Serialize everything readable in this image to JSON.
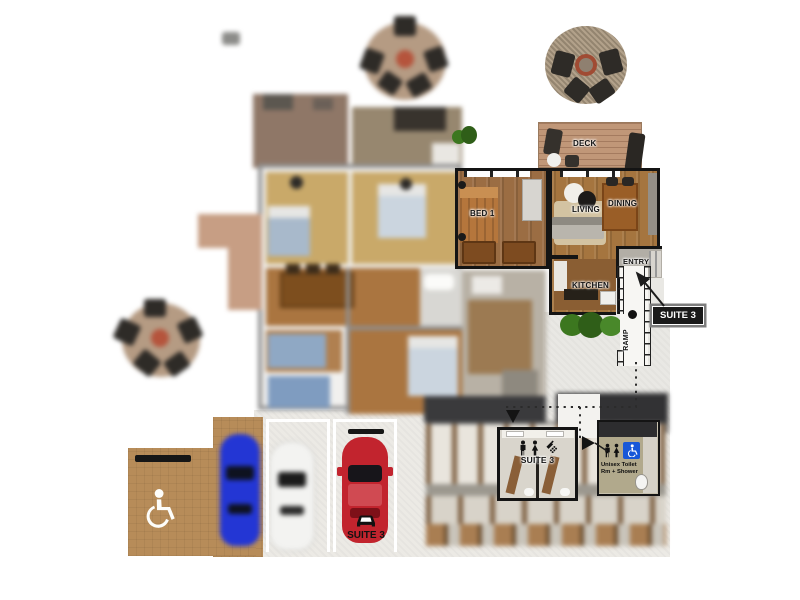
{
  "unit": {
    "bed1": "BED 1",
    "living": "LIVING",
    "dining": "DINING",
    "kitchen": "KITCHEN",
    "entry": "ENTRY",
    "deck": "DECK"
  },
  "site": {
    "ramp": "RAMP",
    "suite_callout": "SUITE 3"
  },
  "bathhouse": {
    "suite_restroom": "SUITE 3",
    "unisex": "Unisex Toilet Rm + Shower"
  },
  "parking": {
    "suite_stall": "SUITE 3"
  },
  "colors": {
    "wall": "#141414",
    "wood_floor": "#a5753f",
    "deck_wood": "#c09778",
    "concrete": "#eceae5",
    "paver_tan": "#b78c59",
    "hedge_green": "#3c771f",
    "accessible_blue": "#1757d8",
    "car_red": "#c2242e",
    "car_blue": "#2336d4",
    "car_white": "#f3f3f1",
    "callout_bg": "#1a1a1a",
    "callout_text": "#ffffff"
  },
  "icons": [
    "wheelchair-icon",
    "male-icon",
    "female-icon",
    "shower-icon",
    "car-icon",
    "fire-pit-icon",
    "down-arrow-icon",
    "right-arrow-icon",
    "callout-arrow-icon"
  ]
}
